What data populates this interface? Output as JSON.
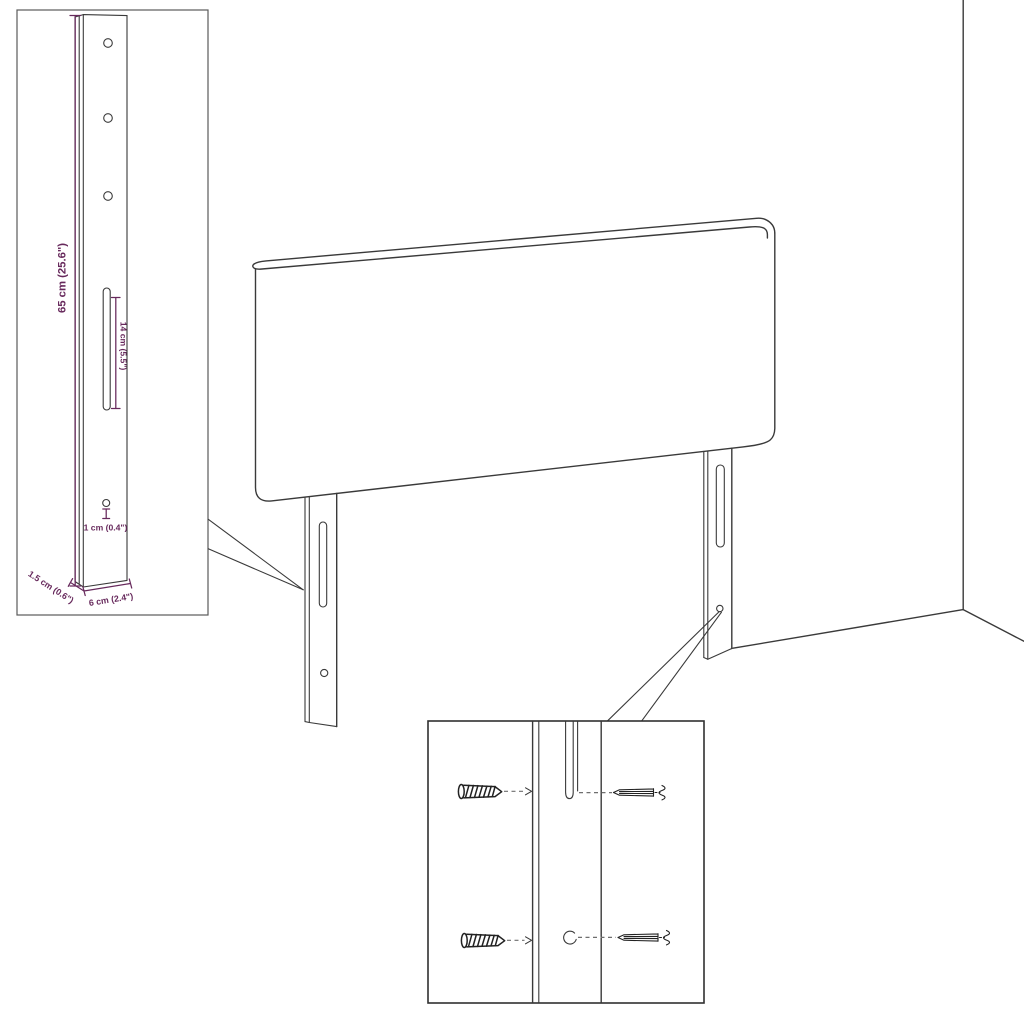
{
  "colors": {
    "background": "#ffffff",
    "line_art": "#3a3a3a",
    "dimension_text": "#67295c",
    "guide_line": "#6f6f6f"
  },
  "dimensions": {
    "leg_height": "65 cm (25.6\")",
    "slot_length": "14 cm (5.5\")",
    "hole_offset": "1 cm (0.4\")",
    "leg_thickness": "1.5 cm (0.6\")",
    "leg_width": "6 cm (2.4\")"
  },
  "icons": {
    "screw": "screw-icon",
    "wall_plug": "wall-plug-icon"
  }
}
